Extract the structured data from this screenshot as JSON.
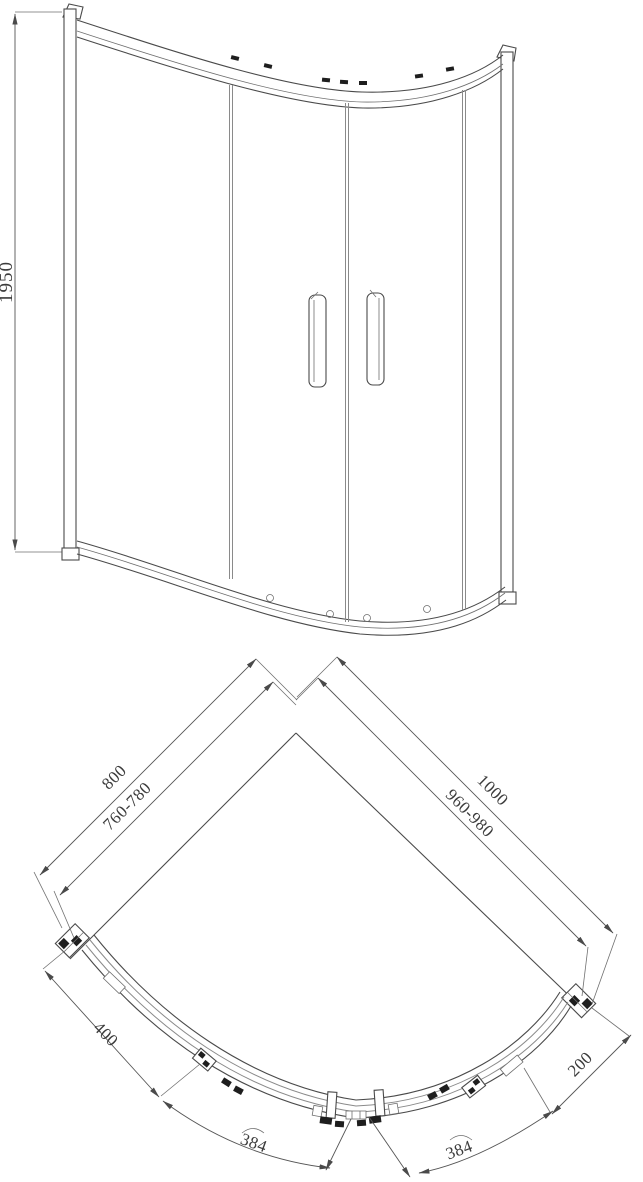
{
  "title": "Quadrant shower enclosure technical drawing",
  "elevation": {
    "height_mm": "1950"
  },
  "plan": {
    "left": {
      "overall_mm": "800",
      "adjustment_mm": "760-780",
      "side_clearance_mm": "400",
      "door_arc_mm": "384"
    },
    "right": {
      "overall_mm": "1000",
      "adjustment_mm": "960-980",
      "side_clearance_mm": "200",
      "door_arc_mm": "384"
    }
  },
  "colors": {
    "line": "#4a4a4a",
    "glass_line": "#8a8a8a",
    "dimension_line": "#555555",
    "text": "#3c3c3c",
    "solid_fill": "#1e1e1e",
    "background": "#ffffff"
  }
}
